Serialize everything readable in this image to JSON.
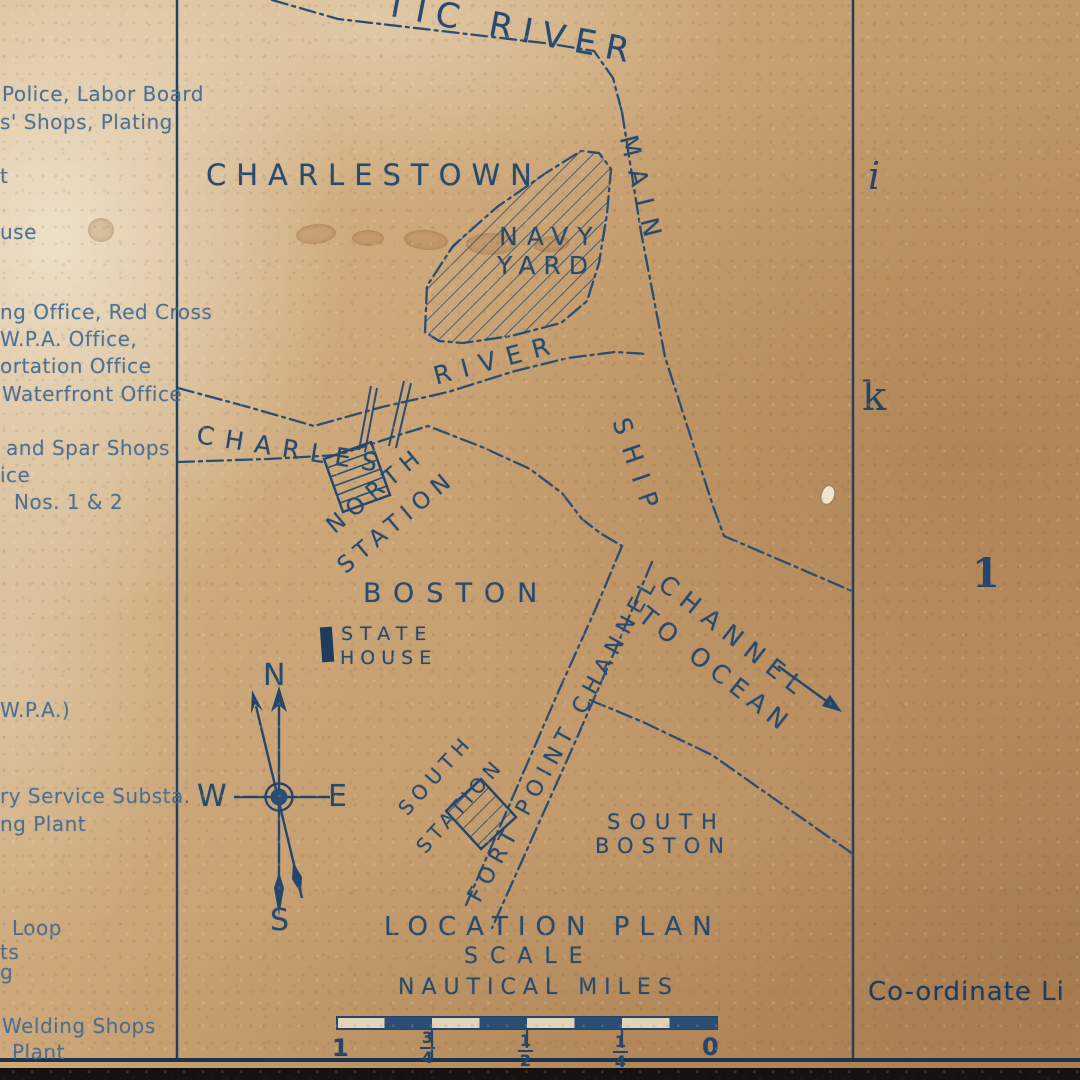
{
  "colors": {
    "ink": "#2a4d74",
    "ink_dark": "#1f3c5e",
    "paper": "#c49c6d",
    "paper_light": "#e7dcc2",
    "left_text": "#416b94"
  },
  "left_panel": {
    "items": [
      "Police, Labor Board",
      "s' Shops, Plating",
      "t",
      "use",
      "ng Office, Red Cross",
      "W.P.A. Office,",
      "ortation Office",
      "Waterfront Office",
      "and Spar Shops",
      "ice",
      "Nos. 1 & 2",
      "W.P.A.)",
      "ry Service Substa.",
      "ng Plant",
      "Loop",
      "ts",
      "g",
      "Welding Shops",
      "Plant"
    ]
  },
  "map": {
    "labels": {
      "mystic_river_fragment": "TIC RIVER",
      "charlestown": "CHARLESTOWN",
      "navy_yard_line1": "NAVY",
      "navy_yard_line2": "YARD",
      "main": "MAIN",
      "ship": "SHIP",
      "charles": "CHARLES",
      "river": "RIVER",
      "north_station_line1": "NORTH",
      "north_station_line2": "STATION",
      "boston": "BOSTON",
      "state_house_line1": "STATE",
      "state_house_line2": "HOUSE",
      "south_station_line1": "SOUTH",
      "south_station_line2": "STATION",
      "fort_point_channel": "FORT POINT CHANNEL",
      "channel_to_ocean_line1": "CHANNEL",
      "channel_to_ocean_line2": "TO OCEAN",
      "south_boston_line1": "SOUTH",
      "south_boston_line2": "BOSTON"
    },
    "compass": {
      "n": "N",
      "e": "E",
      "s": "S",
      "w": "W"
    },
    "title_block": {
      "line1": "LOCATION PLAN",
      "line2": "SCALE",
      "line3": "NAUTICAL MILES"
    },
    "scale_bar": {
      "labels": [
        {
          "whole": "1"
        },
        {
          "num": "3",
          "den": "4"
        },
        {
          "num": "1",
          "den": "2"
        },
        {
          "num": "1",
          "den": "4"
        },
        {
          "whole": "0"
        }
      ]
    },
    "right_margin": {
      "letter_i": "i",
      "letter_k": "k",
      "number_1": "1",
      "coordinate_text": "Co-ordinate Li"
    }
  }
}
